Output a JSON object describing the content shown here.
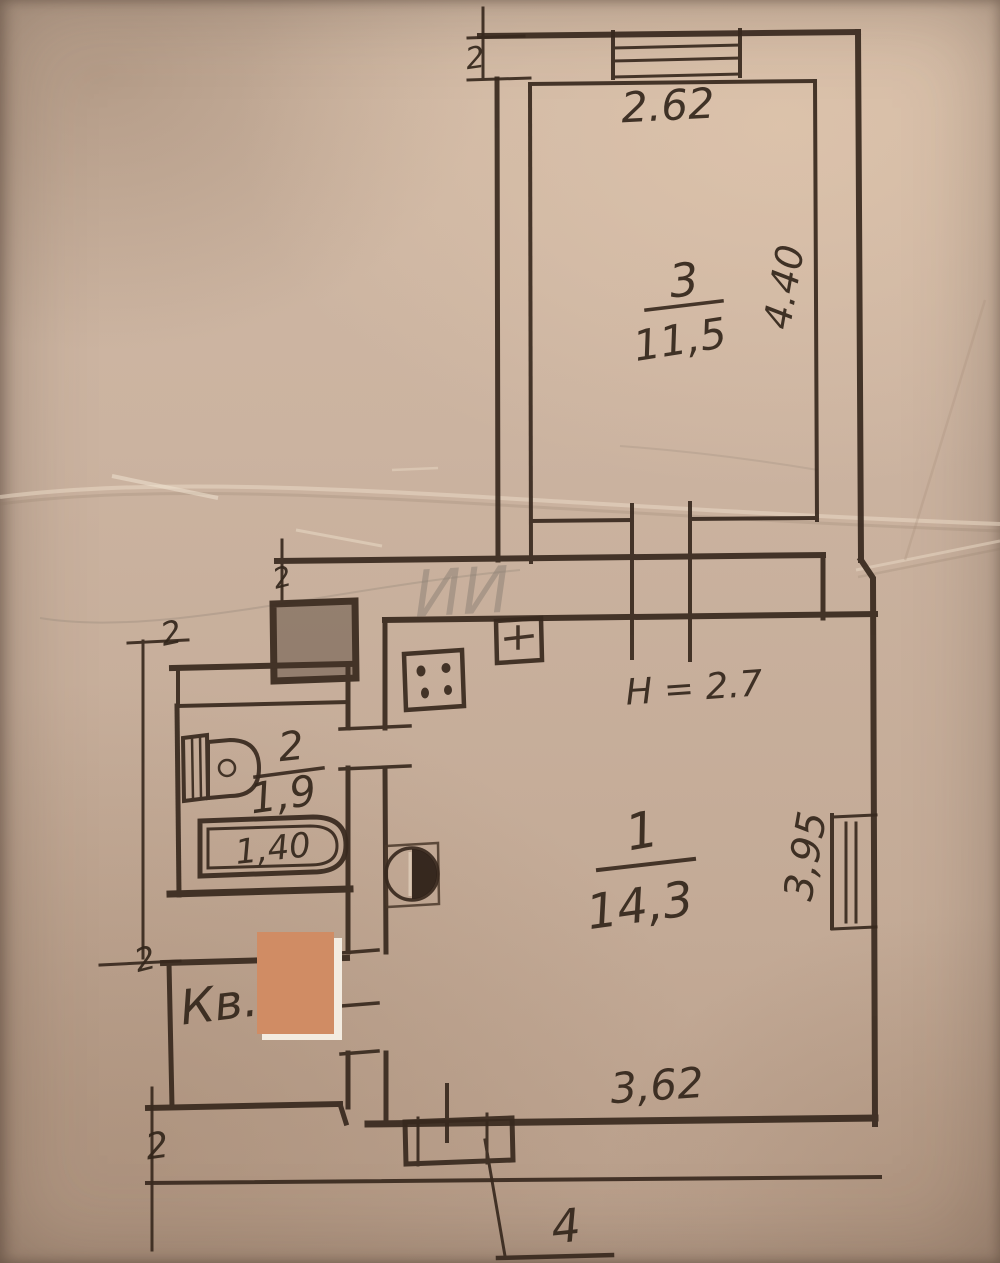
{
  "labels": {
    "top_dimension": "2.62",
    "top_section_marker": "2",
    "room3": {
      "number": "3",
      "area": "11,5",
      "height_dim": "4.40"
    },
    "ceiling_height": "Н = 2.7",
    "room1": {
      "number": "1",
      "area": "14,3",
      "right_dim": "3,95",
      "bottom_dim": "3,62"
    },
    "room2": {
      "number": "2",
      "area": "1,9",
      "bath_length": "1,40"
    },
    "apartment_prefix": "Кв.",
    "porch_marker": "4",
    "left_dim_marker_top": "2",
    "left_dim_marker_bottom": "2",
    "bottom_left_marker": "2",
    "mid_marker": "2",
    "pencil_note": "ИИ"
  },
  "colors": {
    "paper": "#c8b19d",
    "ink": "#38291e",
    "redaction": "#d08c64",
    "redaction_edge": "#f3ece1",
    "pencil": "#8b7f74"
  }
}
